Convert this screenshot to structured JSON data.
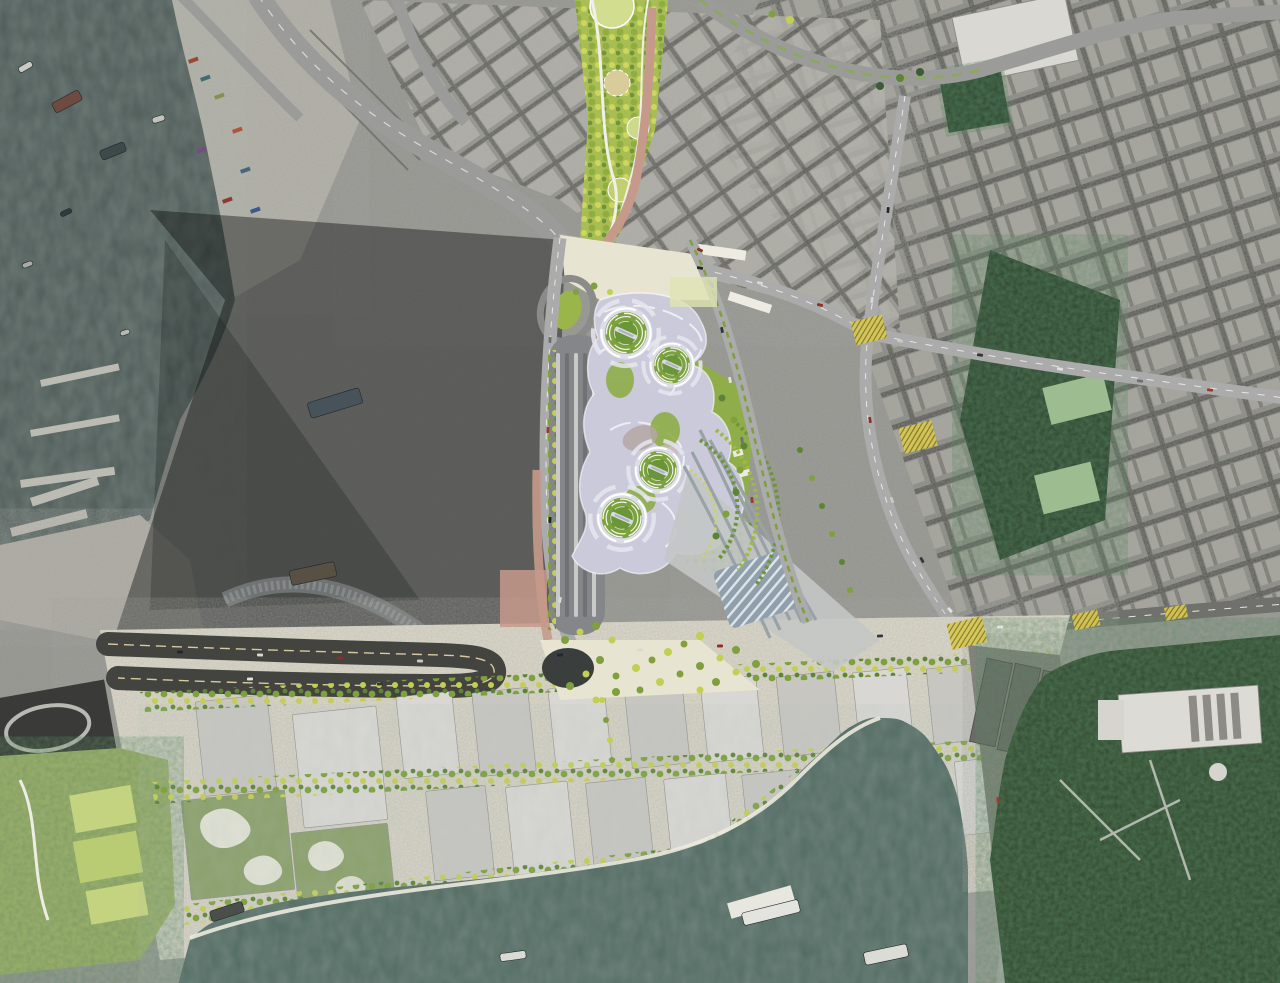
{
  "meta": {
    "title": "Aerial photomontage masterplan — harbour-side station site with spiral green pods, satellite city context",
    "view": "top-down satellite photograph with rendered architectural site plan overlay"
  },
  "palette": {
    "harborWater": "#4d5a57",
    "bayWater": "#4f6a62",
    "satBase": "#94948f",
    "satLight": "#b7b5ae",
    "roadDark": "#434440",
    "roadMid": "#9b9c9a",
    "roadLight": "#aaabaa",
    "paving": "#ddd9cb",
    "plaza": "#e8e4d2",
    "salmon": "#c59a8b",
    "canopy": "#cbcadb",
    "canopyLine": "#f2f1f8",
    "podGreen": "#76a13e",
    "lawn": "#8fae49",
    "tg": "#7fa03c",
    "ty": "#c3cf52",
    "td": "#5d8434",
    "tk": "#3c5c36",
    "hillGreen": "#31452f",
    "parkStrip": "#a9bd55",
    "court": "#9dbd90",
    "yellowBox": "#d8c84f",
    "buildingA": "#c7c6c1",
    "buildingB": "#d8d7d3",
    "greenRoof": "#8ba06b",
    "dock": "#77786f",
    "shadow": "#0b0e0e",
    "pierConcrete": "#b4b2a9",
    "railSteel": "#99a2a7",
    "white": "#eceae2"
  },
  "scene": {
    "pods": [
      [
        626,
        333,
        31
      ],
      [
        672,
        365,
        27
      ],
      [
        658,
        470,
        28
      ],
      [
        622,
        518,
        30
      ]
    ],
    "trees": [
      [
        565,
        640,
        4,
        "tg"
      ],
      [
        580,
        632,
        3.5,
        "ty"
      ],
      [
        596,
        626,
        4,
        "tg"
      ],
      [
        612,
        640,
        3.5,
        "ty"
      ],
      [
        600,
        660,
        4,
        "tg"
      ],
      [
        586,
        674,
        3.5,
        "ty"
      ],
      [
        570,
        686,
        4,
        "tg"
      ],
      [
        616,
        676,
        3.5,
        "tg"
      ],
      [
        636,
        668,
        4,
        "ty"
      ],
      [
        652,
        660,
        3.5,
        "tg"
      ],
      [
        668,
        652,
        4,
        "ty"
      ],
      [
        684,
        644,
        3.5,
        "tg"
      ],
      [
        700,
        636,
        4,
        "ty"
      ],
      [
        640,
        690,
        3.5,
        "tg"
      ],
      [
        660,
        682,
        4,
        "ty"
      ],
      [
        680,
        674,
        3.5,
        "tg"
      ],
      [
        700,
        666,
        4,
        "tg"
      ],
      [
        720,
        658,
        3.5,
        "ty"
      ],
      [
        736,
        650,
        4,
        "tg"
      ],
      [
        596,
        700,
        3.5,
        "ty"
      ],
      [
        616,
        692,
        4,
        "tg"
      ],
      [
        700,
        690,
        3.5,
        "ty"
      ],
      [
        716,
        682,
        4,
        "tg"
      ],
      [
        736,
        672,
        3.5,
        "ty"
      ],
      [
        756,
        664,
        4,
        "tg"
      ],
      [
        800,
        450,
        3,
        "td"
      ],
      [
        812,
        478,
        3,
        "tg"
      ],
      [
        822,
        506,
        3,
        "td"
      ],
      [
        832,
        534,
        3,
        "tg"
      ],
      [
        842,
        562,
        3,
        "td"
      ],
      [
        850,
        590,
        3,
        "tg"
      ],
      [
        594,
        286,
        3.5,
        "tg"
      ],
      [
        610,
        292,
        3,
        "ty"
      ],
      [
        576,
        292,
        3,
        "tg"
      ],
      [
        722,
        398,
        3.5,
        "td"
      ],
      [
        734,
        420,
        3.5,
        "tg"
      ],
      [
        744,
        446,
        3.5,
        "td"
      ],
      [
        740,
        470,
        3.5,
        "tg"
      ],
      [
        736,
        492,
        3.5,
        "td"
      ],
      [
        726,
        514,
        3.5,
        "tg"
      ],
      [
        716,
        536,
        3.5,
        "td"
      ],
      [
        602,
        700,
        3,
        "ty"
      ],
      [
        606,
        720,
        3,
        "tg"
      ],
      [
        610,
        740,
        3,
        "ty"
      ],
      [
        612,
        760,
        3,
        "tg"
      ],
      [
        880,
        86,
        4,
        "tk"
      ],
      [
        900,
        78,
        4,
        "td"
      ],
      [
        920,
        72,
        4,
        "tk"
      ],
      [
        790,
        20,
        4,
        "ty"
      ],
      [
        772,
        14,
        3.5,
        "tg"
      ]
    ],
    "car_colors": [
      "#23262a",
      "#d8d8d4",
      "#8e2f26",
      "#c9c9c4",
      "#31373b",
      "#e2e2de",
      "#6b7074",
      "#9c3a2e"
    ],
    "cars": [
      [
        700,
        268,
        11
      ],
      [
        760,
        283,
        12
      ],
      [
        820,
        305,
        14
      ],
      [
        900,
        341,
        9
      ],
      [
        980,
        355,
        8
      ],
      [
        1060,
        369,
        8
      ],
      [
        1140,
        381,
        7
      ],
      [
        1210,
        390,
        7
      ],
      [
        888,
        210,
        -85
      ],
      [
        872,
        300,
        -83
      ],
      [
        870,
        420,
        80
      ],
      [
        892,
        500,
        70
      ],
      [
        922,
        560,
        60
      ],
      [
        950,
        610,
        50
      ],
      [
        988,
        720,
        85
      ],
      [
        998,
        800,
        87
      ],
      [
        560,
        655,
        -2
      ],
      [
        640,
        650,
        -2
      ],
      [
        720,
        646,
        -2
      ],
      [
        800,
        641,
        -3
      ],
      [
        880,
        636,
        -3
      ],
      [
        1000,
        627,
        -4
      ],
      [
        1090,
        620,
        -4
      ],
      [
        1180,
        612,
        -4
      ],
      [
        180,
        652,
        2
      ],
      [
        260,
        655,
        2
      ],
      [
        340,
        658,
        2
      ],
      [
        420,
        661,
        2
      ],
      [
        380,
        684,
        178
      ],
      [
        250,
        679,
        178
      ],
      [
        550,
        340,
        -88
      ],
      [
        548,
        430,
        -88
      ],
      [
        550,
        520,
        -86
      ],
      [
        560,
        600,
        -80
      ],
      [
        700,
        250,
        25
      ],
      [
        712,
        285,
        70
      ],
      [
        722,
        330,
        78
      ],
      [
        730,
        380,
        80
      ],
      [
        742,
        440,
        82
      ],
      [
        752,
        500,
        83
      ]
    ],
    "boats": [
      [
        52,
        96,
        30,
        11,
        -28,
        "#6e4a40"
      ],
      [
        100,
        146,
        26,
        10,
        -22,
        "#3e4a4a"
      ],
      [
        18,
        64,
        15,
        6,
        -30,
        "#c9cac3"
      ],
      [
        152,
        116,
        13,
        6,
        -18,
        "#c2c3bd"
      ],
      [
        308,
        395,
        54,
        16,
        -17,
        "#47525a"
      ],
      [
        290,
        566,
        46,
        15,
        -12,
        "#585043"
      ],
      [
        120,
        330,
        10,
        5,
        -20,
        "#b7b8b2"
      ],
      [
        60,
        210,
        12,
        5,
        -25,
        "#2e3a3c"
      ],
      [
        22,
        262,
        11,
        5,
        -20,
        "#a9aaa4"
      ],
      [
        742,
        906,
        58,
        13,
        -14,
        "#e4e4df"
      ],
      [
        864,
        948,
        44,
        13,
        -12,
        "#dcdcd6"
      ],
      [
        210,
        906,
        34,
        11,
        -18,
        "#4a4f49"
      ],
      [
        500,
        952,
        26,
        8,
        -8,
        "#dadbd5"
      ]
    ],
    "containers": [
      [
        188,
        60,
        "#9a4733"
      ],
      [
        200,
        78,
        "#3f6d74"
      ],
      [
        214,
        96,
        "#8a8e55"
      ],
      [
        196,
        150,
        "#7a4a86"
      ],
      [
        232,
        130,
        "#b0543c"
      ],
      [
        240,
        170,
        "#46657f"
      ],
      [
        222,
        200,
        "#8e3b2e"
      ],
      [
        250,
        210,
        "#3a5a8a"
      ]
    ],
    "junction_boxes": [
      [
        853,
        318,
        32,
        24,
        -14
      ],
      [
        901,
        424,
        34,
        26,
        -14
      ],
      [
        949,
        620,
        36,
        26,
        -13
      ],
      [
        1073,
        612,
        26,
        16,
        -12
      ],
      [
        1165,
        606,
        22,
        13,
        -10
      ]
    ],
    "buildings": [
      [
        200,
        698,
        72,
        95,
        -6,
        "buildingA"
      ],
      [
        298,
        710,
        84,
        114,
        -6,
        "buildingB"
      ],
      [
        400,
        694,
        56,
        82,
        -6,
        "buildingB"
      ],
      [
        476,
        690,
        56,
        84,
        -6,
        "buildingA"
      ],
      [
        552,
        686,
        56,
        82,
        -6,
        "buildingB"
      ],
      [
        628,
        682,
        58,
        84,
        -6,
        "buildingA"
      ],
      [
        704,
        678,
        56,
        82,
        -6,
        "buildingB"
      ],
      [
        780,
        674,
        58,
        80,
        -6,
        "buildingA"
      ],
      [
        856,
        670,
        54,
        78,
        -6,
        "buildingB"
      ],
      [
        930,
        666,
        54,
        76,
        -6,
        "buildingA"
      ],
      [
        1000,
        663,
        46,
        70,
        -6,
        "buildingB"
      ],
      [
        430,
        788,
        60,
        90,
        -6,
        "buildingA"
      ],
      [
        510,
        784,
        62,
        92,
        -6,
        "buildingB"
      ],
      [
        590,
        780,
        60,
        90,
        -6,
        "buildingA"
      ],
      [
        668,
        776,
        62,
        88,
        -6,
        "buildingB"
      ],
      [
        746,
        772,
        60,
        86,
        -6,
        "buildingA"
      ],
      [
        822,
        768,
        58,
        82,
        -6,
        "buildingB"
      ],
      [
        894,
        764,
        54,
        78,
        -6,
        "buildingA"
      ],
      [
        958,
        759,
        50,
        74,
        -6,
        "buildingB"
      ],
      [
        186,
        795,
        104,
        100,
        -6,
        "greenRoof"
      ],
      [
        295,
        828,
        97,
        84,
        -6,
        "greenRoof"
      ]
    ],
    "warehouses": [
      [
        978,
        660,
        26,
        85
      ],
      [
        1006,
        665,
        26,
        88
      ],
      [
        1034,
        672,
        26,
        88
      ],
      [
        1060,
        680,
        22,
        80
      ]
    ],
    "piers": [
      [
        40,
        380,
        80,
        7,
        -12
      ],
      [
        30,
        430,
        90,
        7,
        -10
      ],
      [
        20,
        480,
        95,
        8,
        -8
      ],
      [
        30,
        498,
        70,
        9,
        -18
      ],
      [
        10,
        528,
        78,
        9,
        -14
      ]
    ]
  }
}
